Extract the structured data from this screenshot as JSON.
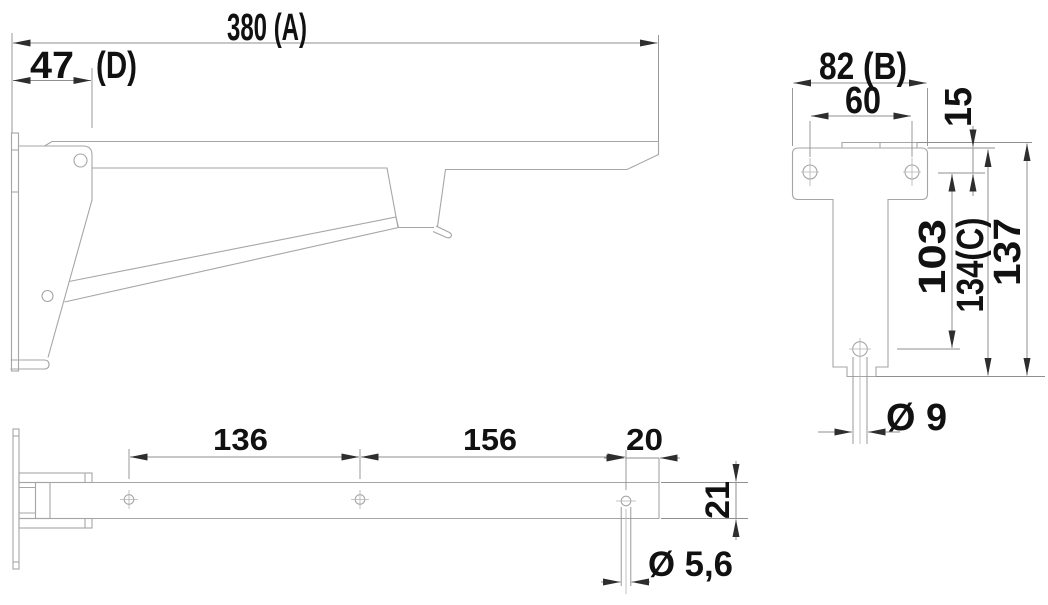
{
  "drawing_title": "folding-bracket-dimension-drawing",
  "dimensions": {
    "side": {
      "total_length": "380 (A)",
      "pivot_offset": "47",
      "pivot_offset_note": "(D)"
    },
    "front": {
      "total_width": "82 (B)",
      "hole_spacing": "60",
      "top_to_hole": "15",
      "hole_to_pin": "103",
      "height_c": "134(C)",
      "total_height": "137",
      "pin_diameter": "Ø 9"
    },
    "plan": {
      "hole_span_1": "136",
      "hole_span_2": "156",
      "hole_to_end": "20",
      "arm_width": "21",
      "hole_diameter": "Ø 5,6"
    }
  },
  "colors": {
    "line": "#a6a6a6",
    "dim_line": "#8f8f8f",
    "thin_line": "#b3b3b3",
    "arrow": "#2e2e2e",
    "text": "#111111",
    "background": "#ffffff"
  }
}
